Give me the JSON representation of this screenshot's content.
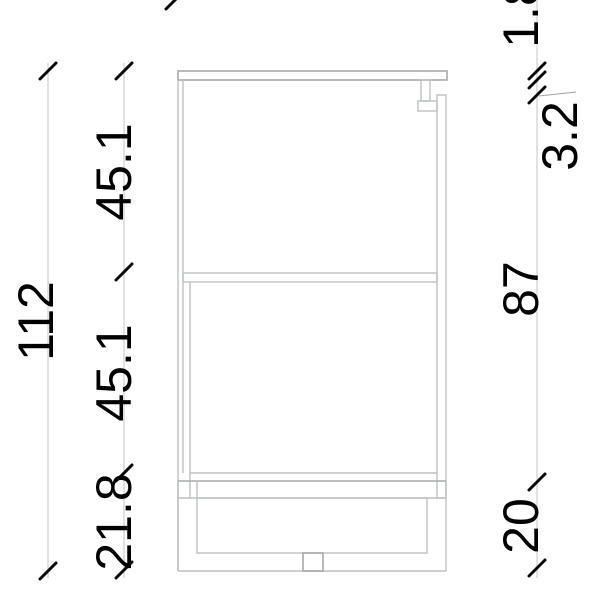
{
  "figure": {
    "type": "technical-drawing",
    "subject": "cabinet-vertical-section"
  },
  "dimensions": {
    "overall_height": {
      "label": "112"
    },
    "left_chain": [
      {
        "label": "45.1"
      },
      {
        "label": "45.1"
      },
      {
        "label": "21.8"
      }
    ],
    "right_chain": [
      {
        "label": "1.8"
      },
      {
        "label": "3.2"
      },
      {
        "label": "87"
      },
      {
        "label": "20"
      }
    ]
  },
  "colors": {
    "background": "#ffffff",
    "drawing_line": "#bdc0c1",
    "dimension_line": "#c9cbcc",
    "tick": "#0a0a0a",
    "text": "#000000"
  }
}
